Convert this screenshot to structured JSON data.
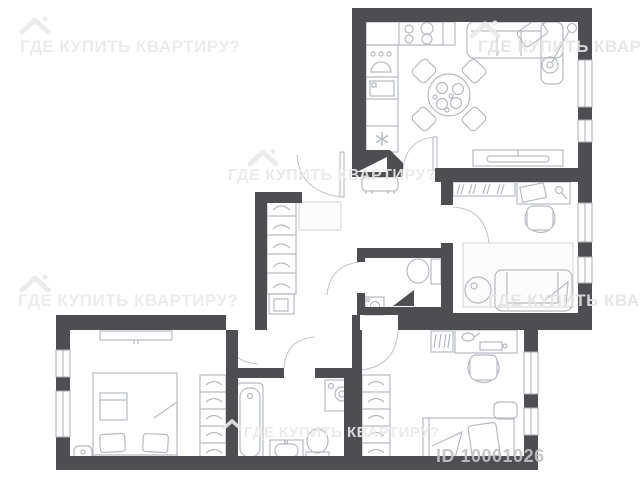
{
  "watermarks": {
    "brand_text": "ГДЕ КУПИТЬ КВАРТИРУ?",
    "brand_text_bottom": "ГДЕ КУПИТЬ КВАРТИРУ?",
    "listing_id": "ID 10001026"
  },
  "colors": {
    "wall": "#4d4d52",
    "floor": "#ffffff",
    "furniture_outline": "#b6bac0",
    "rug_fill": "#fcfcfd",
    "window_outline": "#a9adb2",
    "door_arc": "#c2c6ca",
    "watermark": "#ebebeb",
    "id_text": "#c3c3c3"
  },
  "diagram": {
    "type": "floor-plan",
    "rooms": [
      {
        "name": "kitchen-living-room",
        "furniture": [
          "stove-burners-icon",
          "sink-drops-icon",
          "fridge-icon",
          "freezer-snowflake-icon",
          "round-dining-table",
          "dining-chairs",
          "corner-sofa",
          "floor-lamp-icon",
          "tv-console"
        ]
      },
      {
        "name": "entrance-hall",
        "furniture": [
          "entry-door-wedge",
          "bench",
          "doormat-rug",
          "wardrobe-hangers",
          "shoe-cabinet"
        ]
      },
      {
        "name": "office-bedroom",
        "furniture": [
          "hanger-rack",
          "desk",
          "desk-lamp-icon",
          "chair",
          "rug",
          "sofa",
          "side-table"
        ]
      },
      {
        "name": "wc",
        "furniture": [
          "toilet",
          "corner-sink",
          "vent-shaft-triangle"
        ]
      },
      {
        "name": "bedroom",
        "furniture": [
          "wall-tv",
          "double-bed",
          "pillows",
          "nightstand",
          "wardrobe-hangers"
        ]
      },
      {
        "name": "bathroom",
        "furniture": [
          "bathtub",
          "washing-machine",
          "sink",
          "toilet",
          "vent-shaft-triangle"
        ]
      },
      {
        "name": "children-bedroom",
        "furniture": [
          "hanger-rack",
          "desk",
          "desk-lamp-icon",
          "chair",
          "nightstand",
          "single-bed",
          "wardrobe-hangers"
        ]
      }
    ],
    "windows": [
      "living-room-east-x2",
      "office-east-x2",
      "children-room-east-x2",
      "bedroom-west-x2"
    ]
  }
}
